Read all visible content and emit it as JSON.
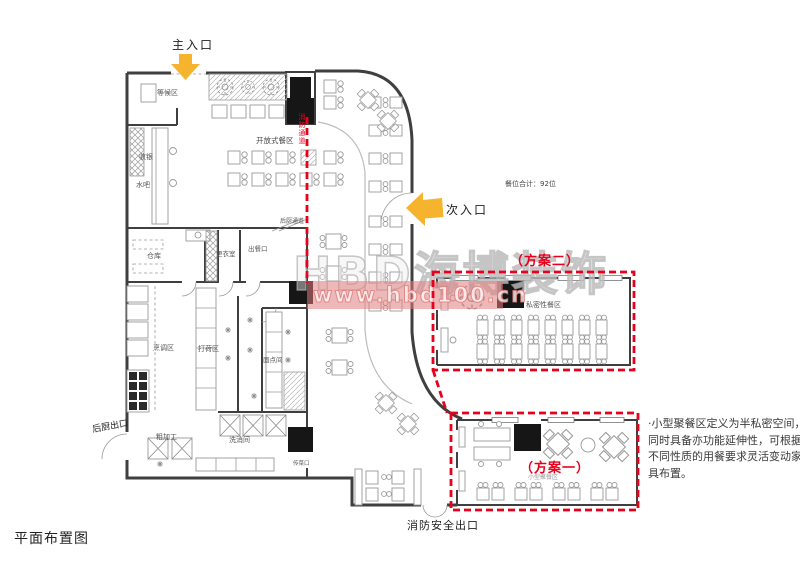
{
  "labels": {
    "title": "平面布置图",
    "main_entrance": "主入口",
    "secondary_entrance": "次入口",
    "waiting": "等候区",
    "cashier": "收银",
    "water_bar": "水吧",
    "open_dining": "开放式餐区",
    "fire_lane": "消防通道",
    "seat_total": "餐位合计：92位",
    "kitchen_corridor": "后厨通道",
    "storage": "仓库",
    "changing_room": "更衣室",
    "serving_port": "出餐口",
    "cooking": "烹调区",
    "prep": "打荷区",
    "pastry": "面点间",
    "rough_processing": "粗加工",
    "washing": "洗消间",
    "kitchen_exit": "后厨出口",
    "food_pass": "传菜口",
    "fire_exit": "消防安全出口",
    "plan2": "（方案二）",
    "private_dining": "私密性餐区",
    "plan1": "（方案一）",
    "plan1_sub": "小型聚餐区",
    "note": "·小型聚餐区定义为半私密空间，同时具备亦功能延伸性，可根据不同性质的用餐要求灵活变动家具布置。"
  },
  "watermark": {
    "brand": "HBD海博装饰",
    "url": "www.hbd100.cn"
  },
  "colors": {
    "annotation_red": "#e8001c",
    "arrow_yellow": "#f6b42e",
    "banner_pink": "#e27d7d",
    "wall_gray": "#3f3f3f"
  }
}
